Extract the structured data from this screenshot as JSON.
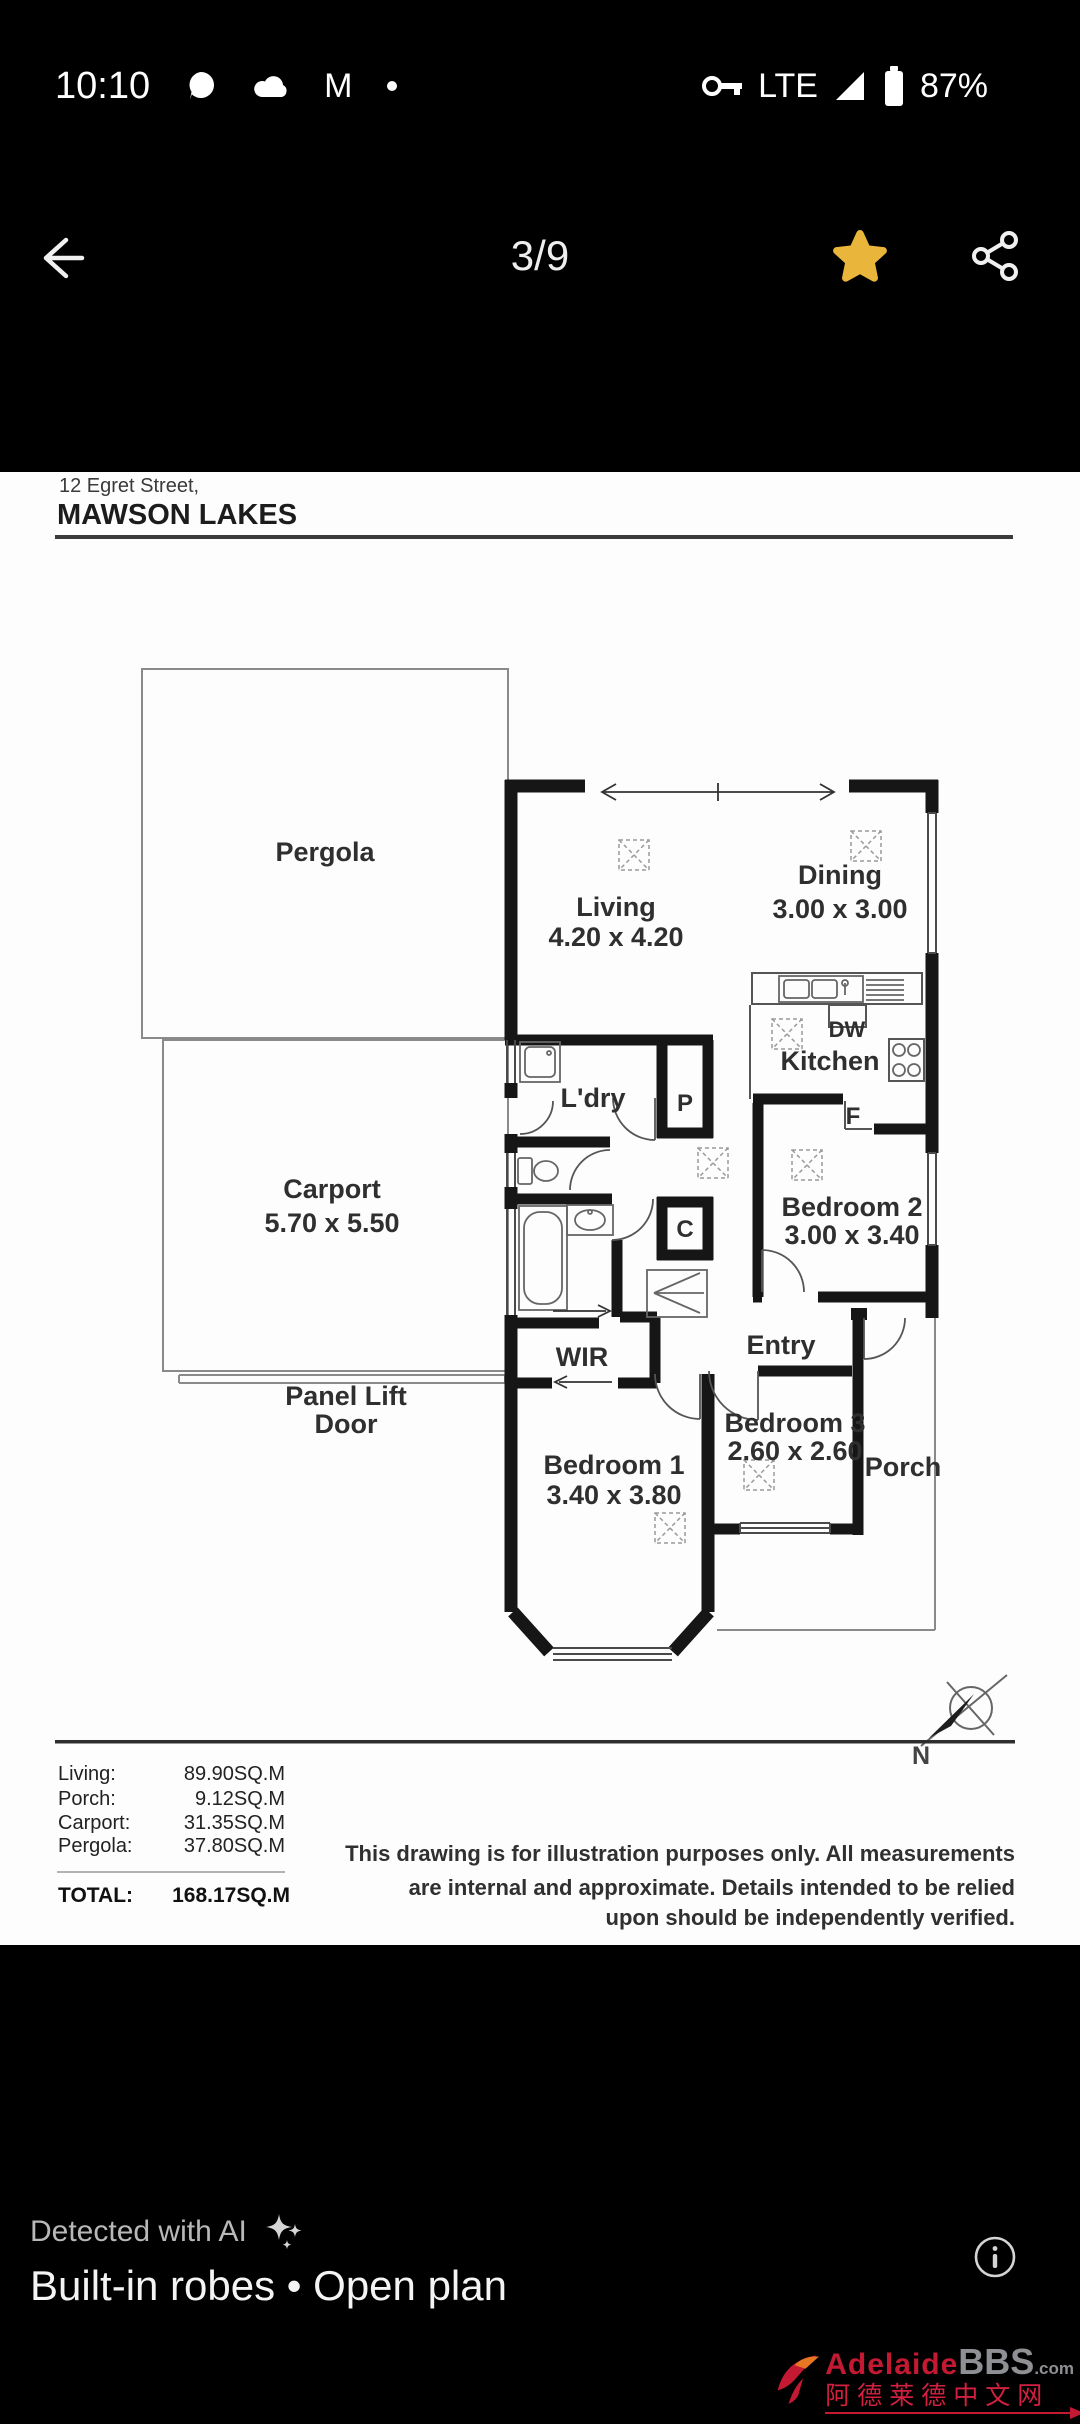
{
  "status_bar": {
    "time": "10:10",
    "network": "LTE",
    "battery_percent": "87%"
  },
  "header": {
    "page_indicator": "3/9"
  },
  "plan": {
    "address_line1": "12 Egret Street,",
    "address_line2": "MAWSON LAKES",
    "rooms": {
      "pergola": {
        "name": "Pergola"
      },
      "carport": {
        "name": "Carport",
        "dims": "5.70 x 5.50"
      },
      "panel_lift_line1": "Panel Lift",
      "panel_lift_line2": "Door",
      "living": {
        "name": "Living",
        "dims": "4.20 x 4.20"
      },
      "dining": {
        "name": "Dining",
        "dims": "3.00 x 3.00"
      },
      "kitchen": {
        "name": "Kitchen"
      },
      "laundry": {
        "name": "L'dry"
      },
      "pantry": "P",
      "cupboard": "C",
      "fridge": "F",
      "dishwasher": "DW",
      "bedroom2": {
        "name": "Bedroom 2",
        "dims": "3.00 x 3.40"
      },
      "wir": {
        "name": "WIR"
      },
      "entry": {
        "name": "Entry"
      },
      "bedroom1": {
        "name": "Bedroom 1",
        "dims": "3.40 x 3.80"
      },
      "bedroom3": {
        "name": "Bedroom 3",
        "dims": "2.60 x 2.60"
      },
      "porch": {
        "name": "Porch"
      }
    },
    "compass": {
      "label": "N"
    },
    "areas": {
      "rows": [
        {
          "label": "Living:",
          "value": "89.90SQ.M"
        },
        {
          "label": "Porch:",
          "value": "9.12SQ.M"
        },
        {
          "label": "Carport:",
          "value": "31.35SQ.M"
        },
        {
          "label": "Pergola:",
          "value": "37.80SQ.M"
        }
      ],
      "total_label": "TOTAL:",
      "total_value": "168.17SQ.M"
    },
    "disclaimer": [
      "This drawing is for illustration purposes only. All measurements",
      "are internal and approximate. Details intended to be relied",
      "upon should be independently verified."
    ]
  },
  "footer": {
    "ai_label": "Detected with AI",
    "features": "Built-in robes • Open plan"
  },
  "watermark": {
    "brand_red": "Adelaide",
    "brand_gray": "BBS",
    "brand_suffix": ".com",
    "chinese": "阿德莱德中文网"
  },
  "colors": {
    "star": "#e9b63b",
    "brand_red": "#c41932",
    "wall": "#161616"
  }
}
